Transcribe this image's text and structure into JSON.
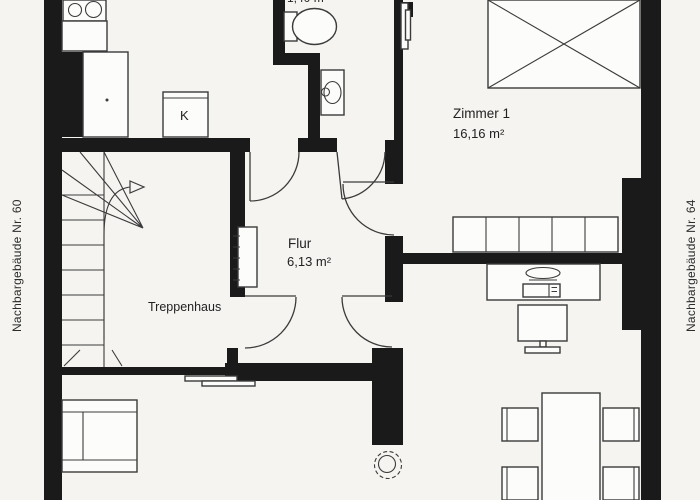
{
  "title": "Wohnungsgrundriss",
  "labels": {
    "wc_area": "1,40 m²",
    "room1_name": "Zimmer 1",
    "room1_area": "16,16 m²",
    "hall_name": "Flur",
    "hall_area": "6,13 m²",
    "stairs_label": "Treppenhaus",
    "fridge_label": "K",
    "neighbor_left": "Nachbargebäude Nr. 60",
    "neighbor_right": "Nachbargebäude Nr. 64"
  },
  "colors": {
    "wall": "#1a1a1a",
    "line": "#3b3b3b",
    "paper": "#f5f4f1",
    "furniture": "#fcfcfa",
    "text": "#222222"
  },
  "symbols": [
    "stove-symbol",
    "kitchen-counter-symbol",
    "tall-cabinet-symbol",
    "fridge-symbol",
    "toilet-symbol",
    "washbasin-symbol",
    "radiator-symbol",
    "bed-symbol",
    "wardrobe-symbol",
    "desk-symbol",
    "monitor-symbol",
    "dining-table-symbol",
    "chair-symbol",
    "plant-symbol",
    "sofa-bed-symbol",
    "staircase-symbol",
    "door-swing-symbol"
  ]
}
